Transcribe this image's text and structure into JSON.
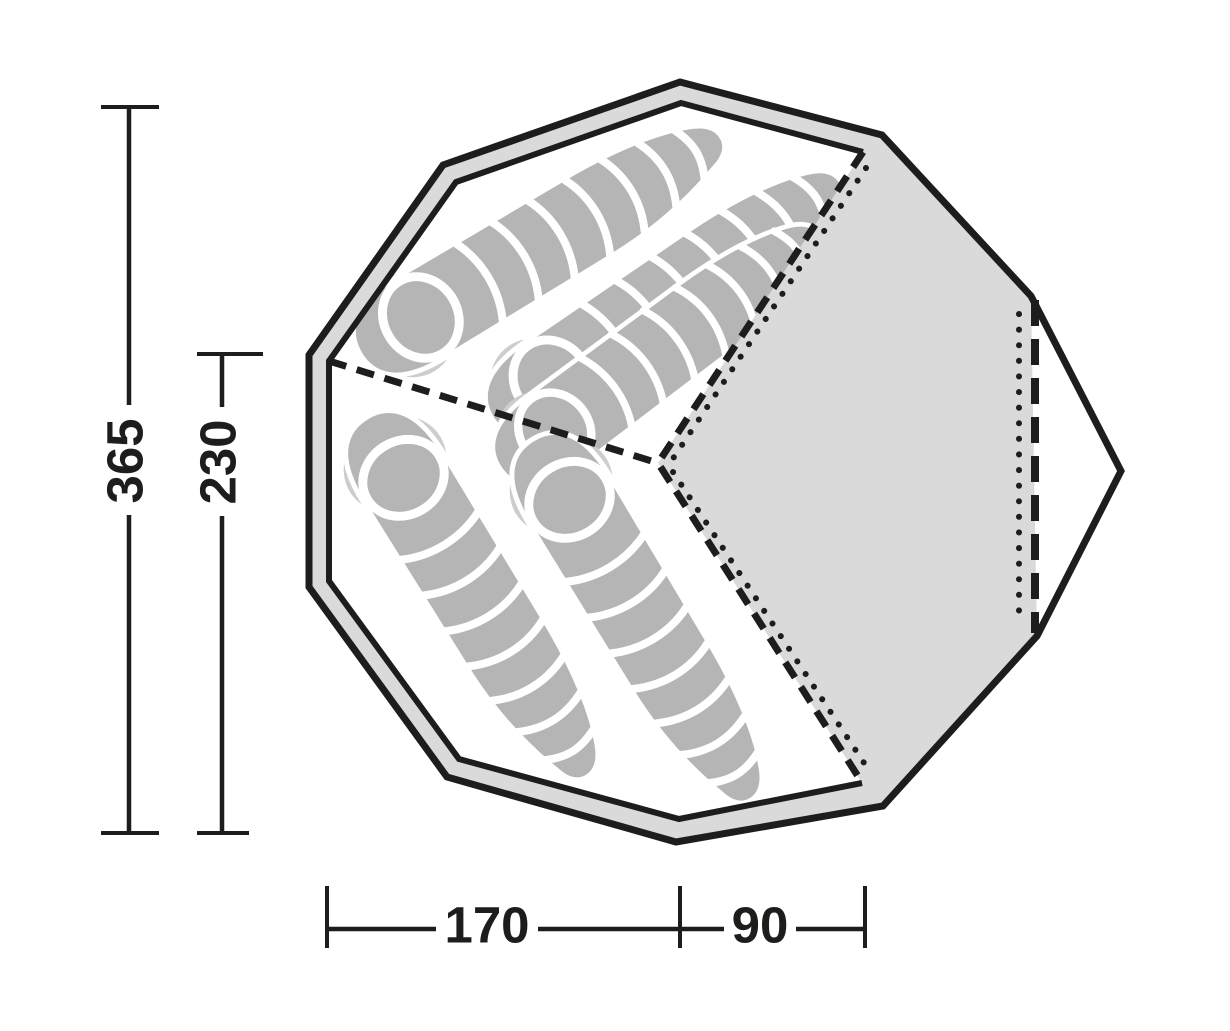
{
  "diagram": {
    "type": "tent-floorplan-top-view",
    "dimensions": {
      "total_depth": "365",
      "inner_depth": "230",
      "floor_width": "170",
      "porch_width": "90"
    },
    "regions": {
      "sleeping_bags_top_cabin": 3,
      "sleeping_bags_bottom_cabin": 2
    },
    "colors": {
      "line": "#1d1d1b",
      "background": "#ffffff",
      "wall_fill": "#dadada",
      "porch_fill": "#dadada",
      "bag_fill": "#b5b5b5",
      "bag_shadow": "#cdcdcd",
      "bag_stripe": "#ffffff",
      "text": "#1d1d1b"
    }
  }
}
